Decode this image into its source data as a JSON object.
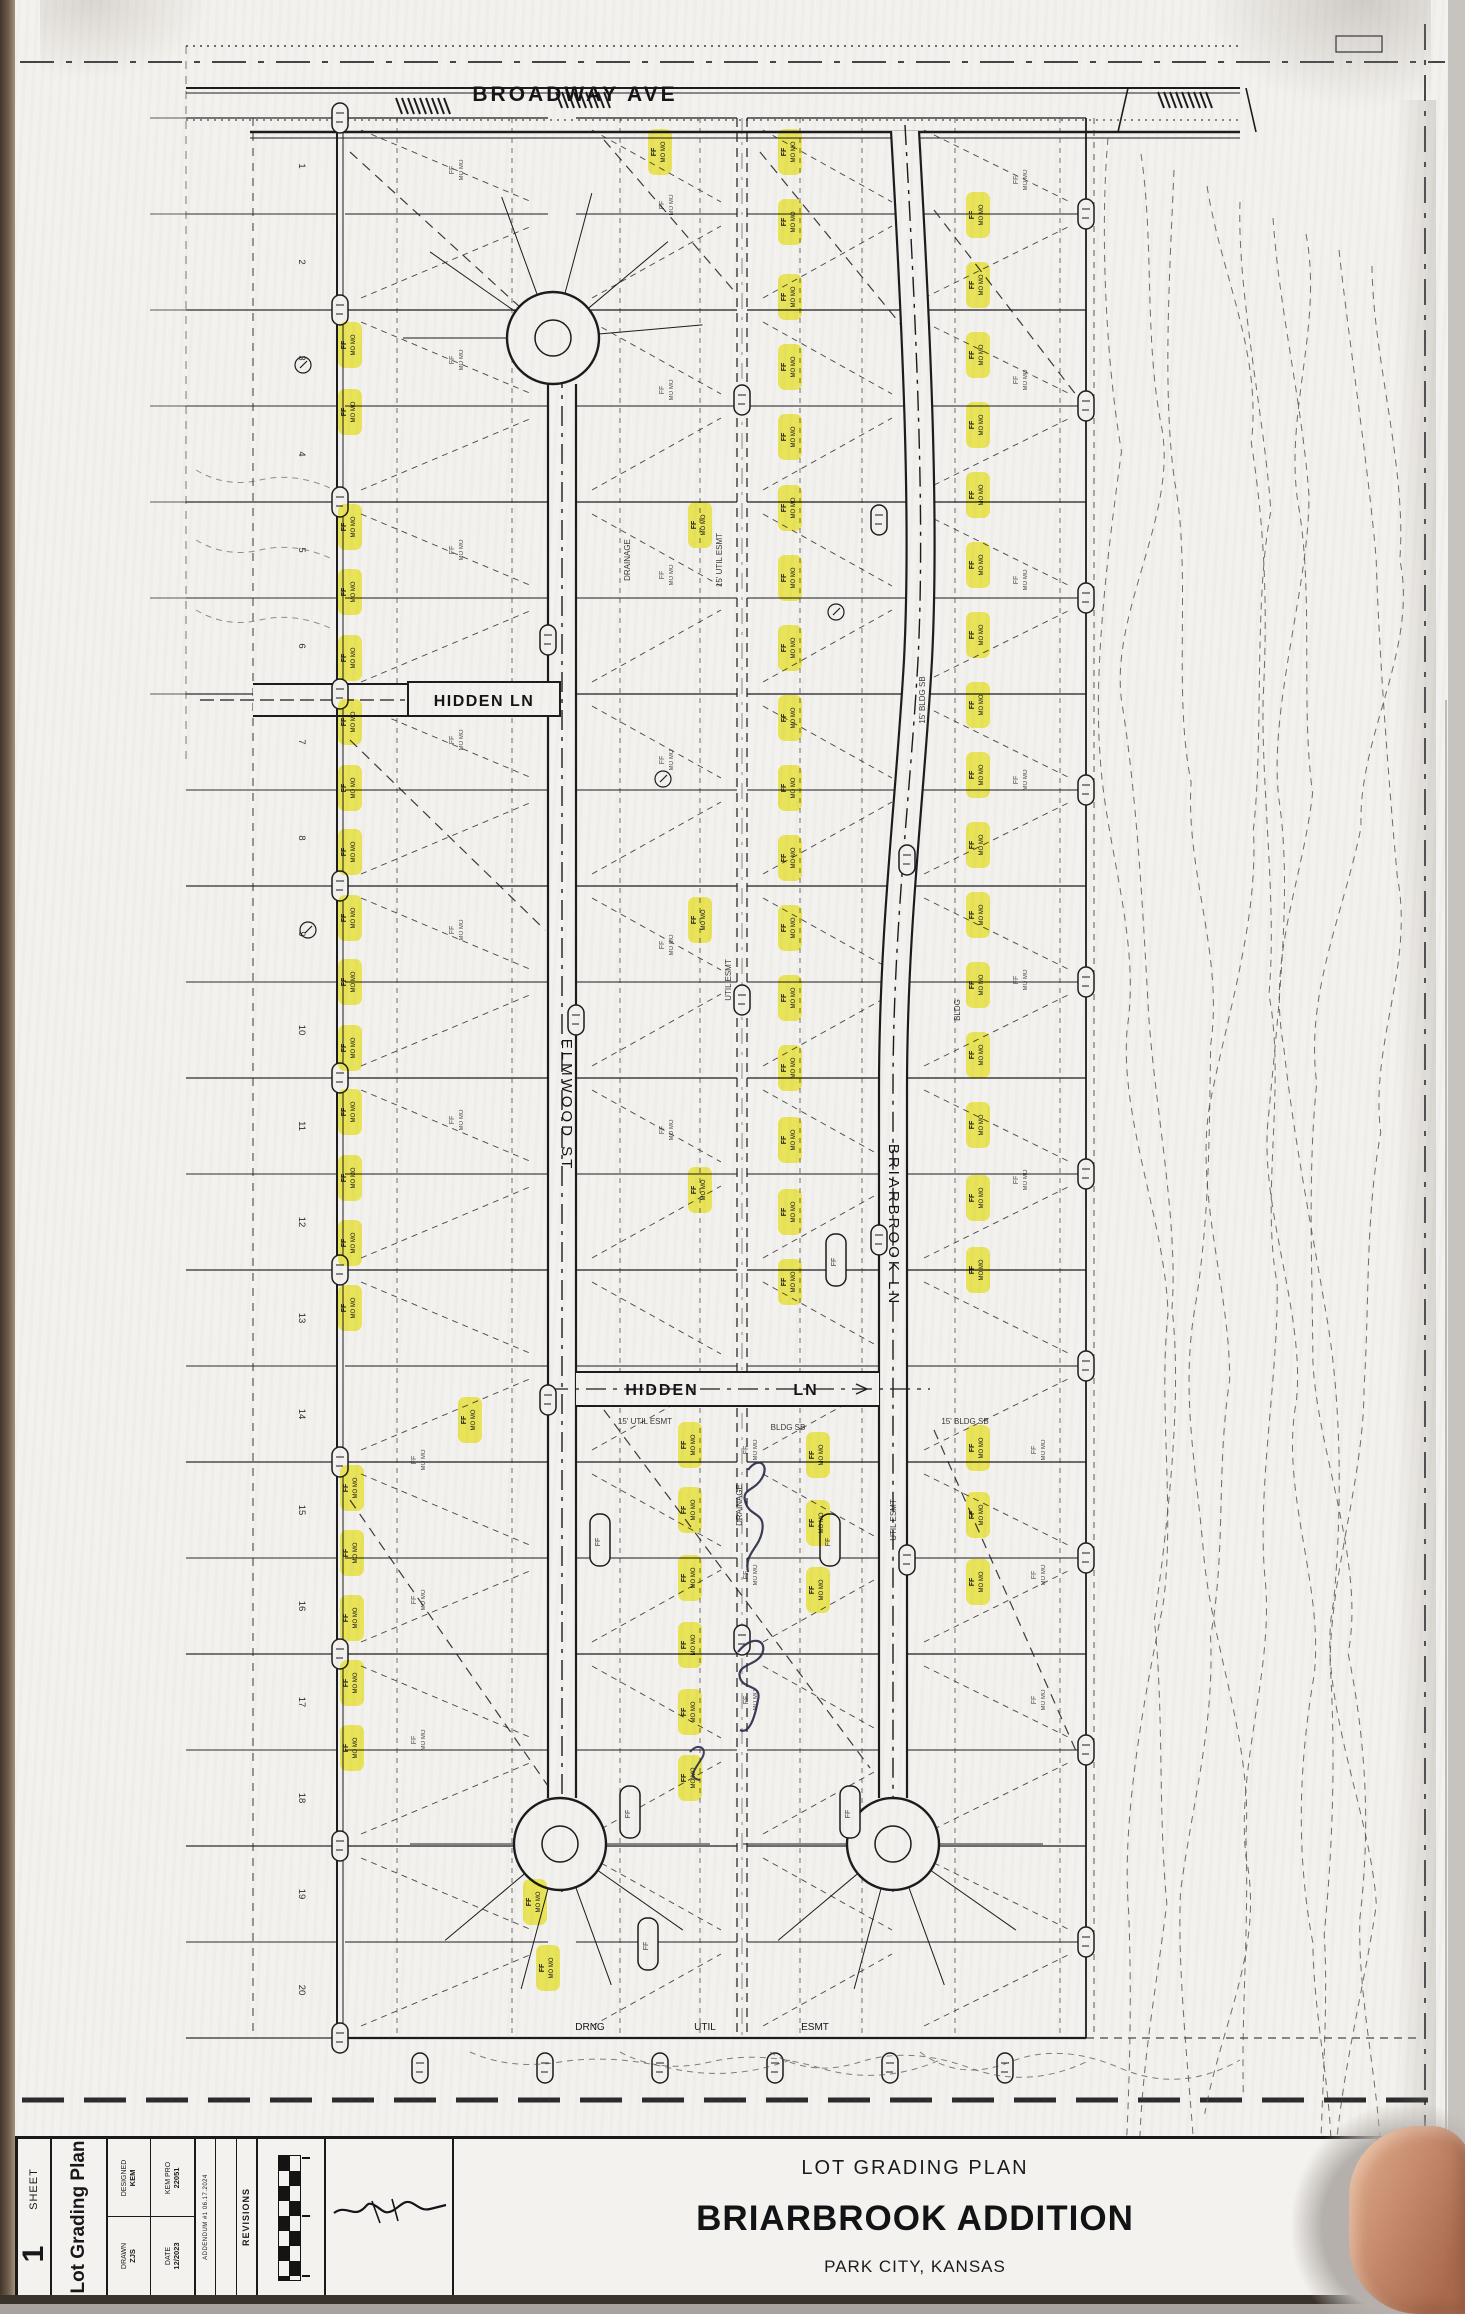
{
  "streets": {
    "broadway": "BROADWAY AVE",
    "hidden_west": "HIDDEN LN",
    "hidden_mid_1": "HIDDEN",
    "hidden_mid_2": "LN",
    "elmwood": "ELMWOOD ST",
    "briarbrook": "BRIARBROOK LN"
  },
  "easements": {
    "drng": "DRNG",
    "util": "UTIL",
    "esmt": "ESMT",
    "bldg": "BLDG",
    "sb": "SB",
    "fifteen": "15'",
    "drainage": "DRAINAGE"
  },
  "labels": {
    "ff": "FF",
    "mo": "MO MO"
  },
  "west_lot_numbers": [
    "1",
    "2",
    "3",
    "4",
    "5",
    "6",
    "7",
    "8",
    "9",
    "10",
    "11",
    "12",
    "13",
    "14",
    "15",
    "16",
    "17",
    "18",
    "19",
    "20"
  ],
  "title_block": {
    "sheet_label": "SHEET",
    "sheet_number": "1",
    "side_title": "Lot Grading Plan",
    "designed_label": "DESIGNED",
    "designed_value": "KEM",
    "proj_label": "KEM PRO",
    "proj_value": "22051",
    "drawn_label": "DRAWN",
    "drawn_value": "ZJS",
    "date_label": "DATE",
    "date_value": "12/2023",
    "addendum": "ADDENDUM #1  06.17.2024",
    "revisions": "REVISIONS",
    "plan_type": "LOT GRADING PLAN",
    "title": "BRIARBROOK ADDITION",
    "location": "PARK CITY, KANSAS",
    "firm": "KEMILLER",
    "firm_sub": "ENGINEERING"
  },
  "colors": {
    "highlight": "#f2ee38",
    "pen": "#2b2b4a",
    "ink": "#1b1b1e"
  },
  "plan": {
    "highlights": [
      [
        350,
        345
      ],
      [
        350,
        412
      ],
      [
        350,
        527
      ],
      [
        350,
        592
      ],
      [
        350,
        658
      ],
      [
        350,
        722
      ],
      [
        350,
        788
      ],
      [
        350,
        852
      ],
      [
        350,
        918
      ],
      [
        350,
        982
      ],
      [
        350,
        1048
      ],
      [
        350,
        1112
      ],
      [
        350,
        1178
      ],
      [
        350,
        1243
      ],
      [
        350,
        1308
      ],
      [
        352,
        1488
      ],
      [
        352,
        1553
      ],
      [
        352,
        1618
      ],
      [
        352,
        1683
      ],
      [
        352,
        1748
      ],
      [
        470,
        1420
      ],
      [
        660,
        152
      ],
      [
        700,
        525
      ],
      [
        700,
        920
      ],
      [
        700,
        1190
      ],
      [
        790,
        152
      ],
      [
        790,
        222
      ],
      [
        790,
        297
      ],
      [
        790,
        367
      ],
      [
        790,
        437
      ],
      [
        790,
        508
      ],
      [
        790,
        578
      ],
      [
        790,
        648
      ],
      [
        790,
        718
      ],
      [
        790,
        788
      ],
      [
        790,
        858
      ],
      [
        790,
        928
      ],
      [
        790,
        998
      ],
      [
        790,
        1068
      ],
      [
        790,
        1140
      ],
      [
        790,
        1212
      ],
      [
        790,
        1282
      ],
      [
        978,
        215
      ],
      [
        978,
        285
      ],
      [
        978,
        355
      ],
      [
        978,
        425
      ],
      [
        978,
        495
      ],
      [
        978,
        565
      ],
      [
        978,
        635
      ],
      [
        978,
        705
      ],
      [
        978,
        775
      ],
      [
        978,
        845
      ],
      [
        978,
        915
      ],
      [
        978,
        985
      ],
      [
        978,
        1055
      ],
      [
        978,
        1125
      ],
      [
        978,
        1198
      ],
      [
        978,
        1270
      ],
      [
        690,
        1445
      ],
      [
        690,
        1510
      ],
      [
        690,
        1578
      ],
      [
        690,
        1645
      ],
      [
        690,
        1712
      ],
      [
        690,
        1778
      ],
      [
        818,
        1455
      ],
      [
        818,
        1523
      ],
      [
        818,
        1590
      ],
      [
        978,
        1448
      ],
      [
        978,
        1515
      ],
      [
        978,
        1582
      ],
      [
        535,
        1902
      ],
      [
        548,
        1968
      ]
    ]
  }
}
